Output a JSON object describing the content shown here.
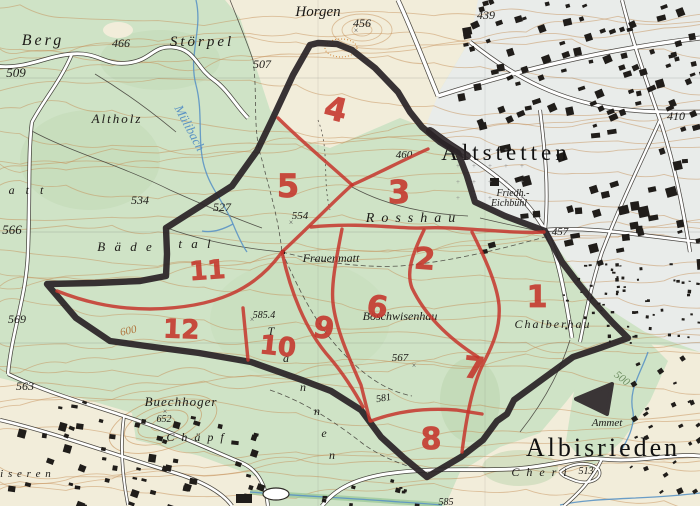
{
  "map": {
    "labels": [
      {
        "t": "Horgen",
        "x": 318,
        "y": 16,
        "s": 15,
        "st": "name"
      },
      {
        "t": "456",
        "x": 362,
        "y": 27,
        "s": 12,
        "st": "num"
      },
      {
        "t": "439",
        "x": 486,
        "y": 19,
        "s": 12,
        "st": "num"
      },
      {
        "t": "Berg",
        "x": 43,
        "y": 45,
        "s": 16,
        "st": "name",
        "sp": 3
      },
      {
        "t": "Störpel",
        "x": 202,
        "y": 46,
        "s": 15,
        "st": "name",
        "sp": 3
      },
      {
        "t": "466",
        "x": 121,
        "y": 47,
        "s": 12,
        "st": "num"
      },
      {
        "t": "509",
        "x": 16,
        "y": 77,
        "s": 13,
        "st": "num"
      },
      {
        "t": "507",
        "x": 262,
        "y": 68,
        "s": 12,
        "st": "num"
      },
      {
        "t": "Altholz",
        "x": 117,
        "y": 123,
        "s": 13,
        "st": "name",
        "sp": 2
      },
      {
        "t": "Mülibach",
        "x": 186,
        "y": 130,
        "s": 13,
        "st": "water",
        "r": 62
      },
      {
        "t": "534",
        "x": 140,
        "y": 204,
        "s": 12,
        "st": "num"
      },
      {
        "t": "527",
        "x": 222,
        "y": 211,
        "s": 12,
        "st": "num"
      },
      {
        "t": "566",
        "x": 12,
        "y": 234,
        "s": 13,
        "st": "num"
      },
      {
        "t": "a t t",
        "x": 28,
        "y": 194,
        "s": 12,
        "st": "name",
        "sp": 4
      },
      {
        "t": "B ä d e",
        "x": 126,
        "y": 251,
        "s": 13,
        "st": "name",
        "sp": 3
      },
      {
        "t": "t a l",
        "x": 196,
        "y": 248,
        "s": 13,
        "st": "name",
        "sp": 3
      },
      {
        "t": "554",
        "x": 300,
        "y": 219,
        "s": 11,
        "st": "num"
      },
      {
        "t": "Rosshau",
        "x": 414,
        "y": 222,
        "s": 14,
        "st": "name",
        "sp": 7
      },
      {
        "t": "460",
        "x": 404,
        "y": 158,
        "s": 11,
        "st": "num"
      },
      {
        "t": "Frauenmatt",
        "x": 331,
        "y": 262,
        "s": 12,
        "st": "name"
      },
      {
        "t": "Altstetten",
        "x": 506,
        "y": 160,
        "s": 23,
        "st": "town",
        "sp": 4
      },
      {
        "t": "Friedh.-",
        "x": 513,
        "y": 196,
        "s": 10,
        "st": "name"
      },
      {
        "t": "Eichbühl",
        "x": 509,
        "y": 206,
        "s": 10,
        "st": "name"
      },
      {
        "t": "457",
        "x": 560,
        "y": 235,
        "s": 11,
        "st": "num"
      },
      {
        "t": "410",
        "x": 676,
        "y": 120,
        "s": 12,
        "st": "num"
      },
      {
        "t": "Chalberhau",
        "x": 553,
        "y": 328,
        "s": 12,
        "st": "name",
        "sp": 2
      },
      {
        "t": "Böschwisenhau",
        "x": 400,
        "y": 320,
        "s": 12,
        "st": "name"
      },
      {
        "t": "567",
        "x": 400,
        "y": 361,
        "s": 11,
        "st": "num"
      },
      {
        "t": "585.4",
        "x": 264,
        "y": 318,
        "s": 10,
        "st": "num"
      },
      {
        "t": "581",
        "x": 384,
        "y": 401,
        "s": 10,
        "st": "num",
        "r": -10
      },
      {
        "t": "600",
        "x": 129,
        "y": 334,
        "s": 11,
        "st": "contour",
        "r": -12
      },
      {
        "t": "500",
        "x": 620,
        "y": 381,
        "s": 11,
        "st": "contour",
        "r": 38,
        "c": "#6f8f62"
      },
      {
        "t": "569",
        "x": 17,
        "y": 323,
        "s": 12,
        "st": "num"
      },
      {
        "t": "563",
        "x": 25,
        "y": 390,
        "s": 12,
        "st": "num"
      },
      {
        "t": "Buechhoger",
        "x": 181,
        "y": 406,
        "s": 13,
        "st": "name",
        "sp": 1
      },
      {
        "t": "652",
        "x": 164,
        "y": 422,
        "s": 10,
        "st": "num"
      },
      {
        "t": "C h ä p f",
        "x": 196,
        "y": 441,
        "s": 12,
        "st": "name",
        "sp": 2
      },
      {
        "t": "i s e r e n",
        "x": 26,
        "y": 477,
        "s": 11,
        "st": "name",
        "sp": 1
      },
      {
        "t": "Albisrieden",
        "x": 603,
        "y": 456,
        "s": 26,
        "st": "town",
        "sp": 3
      },
      {
        "t": "C h e r i",
        "x": 540,
        "y": 476,
        "s": 12,
        "st": "name",
        "sp": 2
      },
      {
        "t": "513",
        "x": 586,
        "y": 474,
        "s": 10,
        "st": "num"
      },
      {
        "t": "Ammet",
        "x": 607,
        "y": 426,
        "s": 11,
        "st": "name"
      },
      {
        "t": "585",
        "x": 446,
        "y": 505,
        "s": 10,
        "st": "num"
      },
      {
        "t": "T",
        "x": 271,
        "y": 335,
        "s": 12,
        "st": "name"
      },
      {
        "t": "a",
        "x": 286,
        "y": 362,
        "s": 12,
        "st": "name"
      },
      {
        "t": "n",
        "x": 303,
        "y": 391,
        "s": 12,
        "st": "name"
      },
      {
        "t": "n",
        "x": 317,
        "y": 415,
        "s": 12,
        "st": "name"
      },
      {
        "t": "e",
        "x": 324,
        "y": 437,
        "s": 12,
        "st": "name"
      },
      {
        "t": "n",
        "x": 332,
        "y": 459,
        "s": 12,
        "st": "name"
      }
    ],
    "zones": [
      {
        "n": "1",
        "x": 537,
        "y": 307,
        "s": 30,
        "r": 0
      },
      {
        "n": "2",
        "x": 424,
        "y": 269,
        "s": 30,
        "r": 4
      },
      {
        "n": "3",
        "x": 399,
        "y": 203,
        "s": 32,
        "r": 0
      },
      {
        "n": "4",
        "x": 333,
        "y": 120,
        "s": 32,
        "r": 14
      },
      {
        "n": "5",
        "x": 288,
        "y": 197,
        "s": 32,
        "r": 0
      },
      {
        "n": "6",
        "x": 376,
        "y": 317,
        "s": 30,
        "r": 8
      },
      {
        "n": "7",
        "x": 473,
        "y": 378,
        "s": 30,
        "r": 6
      },
      {
        "n": "8",
        "x": 431,
        "y": 449,
        "s": 30,
        "r": 0
      },
      {
        "n": "9",
        "x": 322,
        "y": 338,
        "s": 30,
        "r": 10
      },
      {
        "n": "10",
        "x": 277,
        "y": 355,
        "s": 26,
        "r": 6
      },
      {
        "n": "11",
        "x": 208,
        "y": 279,
        "s": 26,
        "r": -4
      },
      {
        "n": "12",
        "x": 181,
        "y": 338,
        "s": 26,
        "r": 2
      }
    ],
    "colors": {
      "forest": "#cfe3c6",
      "forest_dark": "#b9d4ab",
      "field": "#f2edda",
      "urban": "#e9ecea",
      "contour": "#c69057",
      "water": "#5b93c4",
      "building": "#201d1a",
      "marker_black": "#2a2327",
      "marker_red": "#c5352b",
      "label": "#1c1a17",
      "road_casing": "#2e2a26"
    }
  },
  "annotation": {
    "boundary_path": "M318,43 L337,44 L352,50 L375,68 L398,92 L410,112 L422,127 L440,142 L458,153 L467,176 L475,202 L505,216 L545,231 L562,262 L578,283 L592,300 L612,322 L628,338 L600,348 L573,357 L540,381 L514,400 L507,414 L497,421 L483,440 L461,457 L427,477 L404,458 L381,437 L361,410 L331,391 L302,380 L251,362 L199,353 L146,346 L110,341 L76,318 L47,284 L95,283 L140,281 L166,276 L167,254 L166,228 L199,207 L232,186 L257,151 L272,120 L293,75 L310,45 Z",
    "boundary_spur": "M430,131 L448,144 L467,156",
    "arrow_path": "M612,384 L576,399 L607,414 Z",
    "red_lines": [
      "M278,118 C300,140 330,165 352,185",
      "M428,149 C403,160 375,175 352,185",
      "M352,185 C335,200 310,226 282,252",
      "M311,227 C360,222 400,229 422,228 C460,226 505,234 544,232",
      "M342,229 C336,260 331,285 333,303 C336,330 350,360 361,385 L370,421",
      "M424,230 C412,255 406,272 412,288 C425,315 448,338 478,357",
      "M472,232 C486,260 497,285 499,305 C501,330 490,350 484,362 C472,385 466,420 462,452",
      "M282,252 C255,290 215,308 150,309 C110,309 80,300 57,291",
      "M243,308 L248,360",
      "M282,252 C290,290 305,330 330,358 C342,372 355,392 363,407",
      "M371,421 C400,410 430,408 456,410 L482,414"
    ]
  }
}
